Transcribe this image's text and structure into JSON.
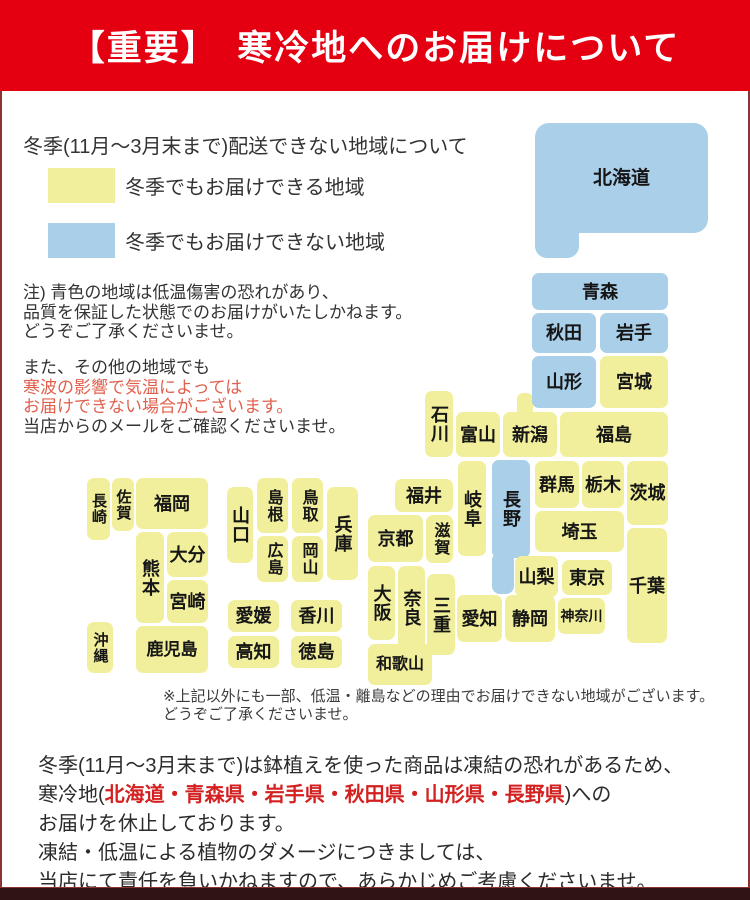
{
  "header": {
    "title": "【重要】　寒冷地へのお届けについて"
  },
  "colors": {
    "header_bg": "#e50011",
    "header_text": "#ffffff",
    "deliverable_fill": "#f1ef9b",
    "not_deliverable_fill": "#a9cfe9",
    "warning_red": "#e0604e",
    "strong_red": "#d32020",
    "border_color": "#8b3434",
    "bottom_bar": "#2f1315",
    "text_dark": "#333333"
  },
  "legend": {
    "title": "冬季(11月～3月末まで)配送できない地域について",
    "items": [
      {
        "status": "deliverable",
        "color": "#f1ef9b",
        "label": "冬季でもお届けできる地域"
      },
      {
        "status": "not_deliverable",
        "color": "#a9cfe9",
        "label": "冬季でもお届けできない地域"
      }
    ]
  },
  "notes": {
    "note1_lines": [
      "注) 青色の地域は低温傷害の恐れがあり、",
      "品質を保証した状態でのお届けがいたしかねます。",
      "どうぞご了承くださいませ。"
    ],
    "note2_lines": [
      {
        "text": "また、その他の地域でも",
        "red": false
      },
      {
        "text": "寒波の影響で気温によっては",
        "red": true
      },
      {
        "text": "お届けできない場合がございます。",
        "red": true
      },
      {
        "text": "当店からのメールをご確認くださいませ。",
        "red": false
      }
    ]
  },
  "map": {
    "prefectures": [
      {
        "id": "hokkaido",
        "label": "北海道",
        "status": "no"
      },
      {
        "id": "aomori",
        "label": "青森",
        "status": "no"
      },
      {
        "id": "akita",
        "label": "秋田",
        "status": "no"
      },
      {
        "id": "iwate",
        "label": "岩手",
        "status": "no"
      },
      {
        "id": "yamagata",
        "label": "山形",
        "status": "no"
      },
      {
        "id": "miyagi",
        "label": "宮城",
        "status": "ok"
      },
      {
        "id": "niigata",
        "label": "新潟",
        "status": "ok"
      },
      {
        "id": "fukushima",
        "label": "福島",
        "status": "ok"
      },
      {
        "id": "ishikawa",
        "label": "石川",
        "status": "ok"
      },
      {
        "id": "toyama",
        "label": "富山",
        "status": "ok"
      },
      {
        "id": "fukui",
        "label": "福井",
        "status": "ok"
      },
      {
        "id": "gifu",
        "label": "岐阜",
        "status": "ok"
      },
      {
        "id": "nagano",
        "label": "長野",
        "status": "no"
      },
      {
        "id": "gunma",
        "label": "群馬",
        "status": "ok"
      },
      {
        "id": "tochigi",
        "label": "栃木",
        "status": "ok"
      },
      {
        "id": "ibaraki",
        "label": "茨城",
        "status": "ok"
      },
      {
        "id": "saitama",
        "label": "埼玉",
        "status": "ok"
      },
      {
        "id": "chiba",
        "label": "千葉",
        "status": "ok"
      },
      {
        "id": "yamanashi",
        "label": "山梨",
        "status": "ok"
      },
      {
        "id": "tokyo",
        "label": "東京",
        "status": "ok"
      },
      {
        "id": "kanagawa",
        "label": "神奈川",
        "status": "ok"
      },
      {
        "id": "shizuoka",
        "label": "静岡",
        "status": "ok"
      },
      {
        "id": "aichi",
        "label": "愛知",
        "status": "ok"
      },
      {
        "id": "mie",
        "label": "三重",
        "status": "ok"
      },
      {
        "id": "shiga",
        "label": "滋賀",
        "status": "ok"
      },
      {
        "id": "kyoto",
        "label": "京都",
        "status": "ok"
      },
      {
        "id": "nara",
        "label": "奈良",
        "status": "ok"
      },
      {
        "id": "osaka",
        "label": "大阪",
        "status": "ok"
      },
      {
        "id": "wakayama",
        "label": "和歌山",
        "status": "ok"
      },
      {
        "id": "hyogo",
        "label": "兵庫",
        "status": "ok"
      },
      {
        "id": "tottori",
        "label": "鳥取",
        "status": "ok"
      },
      {
        "id": "okayama",
        "label": "岡山",
        "status": "ok"
      },
      {
        "id": "shimane",
        "label": "島根",
        "status": "ok"
      },
      {
        "id": "hiroshima",
        "label": "広島",
        "status": "ok"
      },
      {
        "id": "yamaguchi",
        "label": "山口",
        "status": "ok"
      },
      {
        "id": "kagawa",
        "label": "香川",
        "status": "ok"
      },
      {
        "id": "ehime",
        "label": "愛媛",
        "status": "ok"
      },
      {
        "id": "kochi",
        "label": "高知",
        "status": "ok"
      },
      {
        "id": "tokushima",
        "label": "徳島",
        "status": "ok"
      },
      {
        "id": "fukuoka",
        "label": "福岡",
        "status": "ok"
      },
      {
        "id": "saga",
        "label": "佐賀",
        "status": "ok"
      },
      {
        "id": "nagasaki",
        "label": "長崎",
        "status": "ok"
      },
      {
        "id": "kumamoto",
        "label": "熊本",
        "status": "ok"
      },
      {
        "id": "oita",
        "label": "大分",
        "status": "ok"
      },
      {
        "id": "miyazaki",
        "label": "宮崎",
        "status": "ok"
      },
      {
        "id": "kagoshima",
        "label": "鹿児島",
        "status": "ok"
      },
      {
        "id": "okinawa",
        "label": "沖縄",
        "status": "ok"
      }
    ]
  },
  "footnote_lines": [
    "※上記以外にも一部、低温・離島などの理由でお届けできない地域がございます。",
    "どうぞご了承くださいませ。"
  ],
  "footer": {
    "lines": [
      [
        {
          "t": "冬季(11月～3月末まで)は鉢植えを使った商品は凍結の恐れがあるため、",
          "red": false
        }
      ],
      [
        {
          "t": "寒冷地(",
          "red": false
        },
        {
          "t": "北海道・青森県・岩手県・秋田県・山形県・長野県",
          "red": true
        },
        {
          "t": ")への",
          "red": false
        }
      ],
      [
        {
          "t": "お届けを休止しております。",
          "red": false
        }
      ],
      [
        {
          "t": "凍結・低温による植物のダメージにつきましては、",
          "red": false
        }
      ],
      [
        {
          "t": "当店にて責任を負いかねますので、あらかじめご考慮くださいませ。",
          "red": false
        }
      ]
    ]
  }
}
